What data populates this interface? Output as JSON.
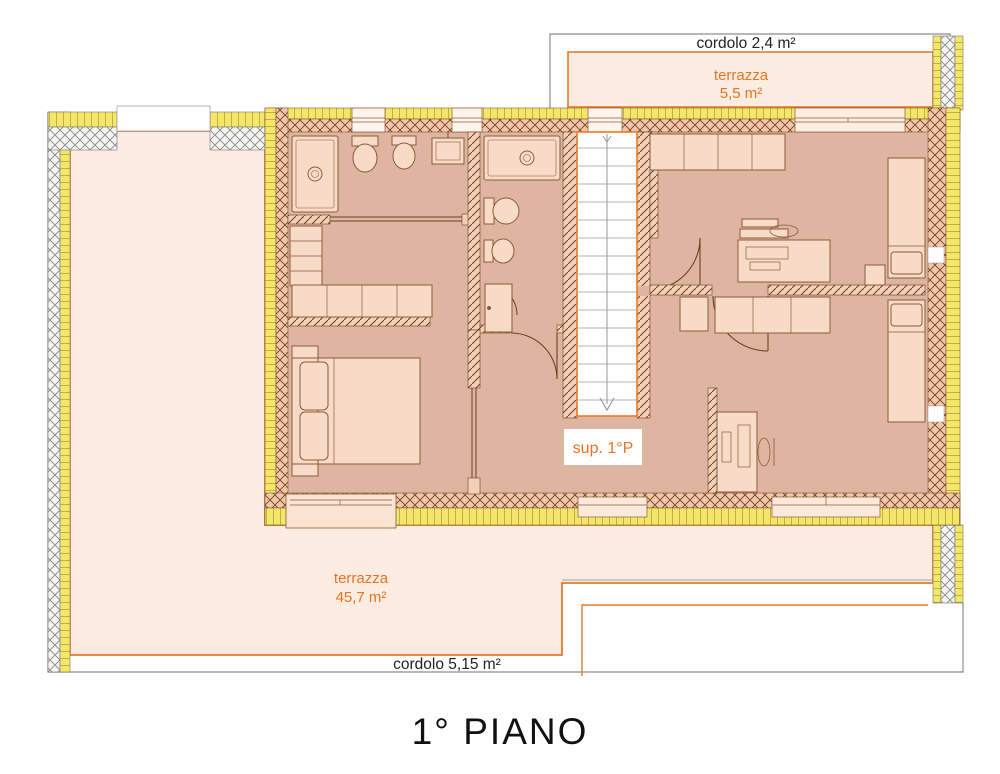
{
  "document": {
    "title": "1° PIANO"
  },
  "labels": {
    "cordolo_top": "cordolo 2,4 m²",
    "terrace_top_name": "terrazza",
    "terrace_top_area": "5,5 m²",
    "stair_label": "sup. 1°P",
    "terrace_main_name": "terrazza",
    "terrace_main_area": "45,7 m²",
    "cordolo_bottom": "cordolo 5,15 m²"
  },
  "colors": {
    "accent_orange": "#e87a28",
    "terrace_fill": "#fcece1",
    "floor_fill": "#deb5a0",
    "insulation_yellow": "#f4e668",
    "wall_hatch_bg": "#f1c6ab",
    "cordolo_gray": "#8c8c8c",
    "text_black": "#222222"
  },
  "fixtures": [
    "stairs",
    "double-bed",
    "single-bed",
    "single-bed",
    "desk",
    "desk",
    "wardrobe",
    "wardrobe",
    "closet-shelves",
    "shower",
    "shower",
    "toilet",
    "toilet",
    "bidet",
    "bidet",
    "sink"
  ]
}
